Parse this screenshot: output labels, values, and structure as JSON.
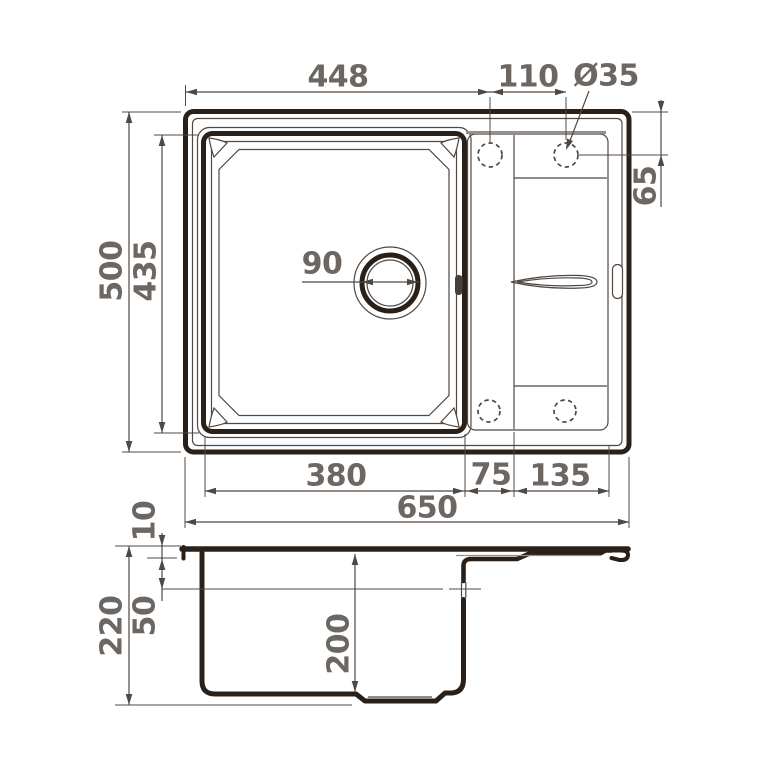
{
  "drawing_title": "sink-dimension-drawing",
  "colors": {
    "ink": "#2b2018",
    "line": "#4f4843",
    "text": "#6c6762",
    "ledge": "#95908a",
    "background": "#ffffff"
  },
  "top_view": {
    "dim_edge_to_hole": "448",
    "dim_hole_spacing": "110",
    "dim_hole_diameter": "Ø35",
    "dim_hole_offset": "65",
    "dim_overall_depth": "500",
    "dim_bowl_depth": "435",
    "dim_drain_diameter": "90",
    "dim_bowl_width": "380",
    "dim_web_width": "75",
    "dim_wing_width": "135",
    "dim_overall_width": "650"
  },
  "section_view": {
    "dim_rim_height": "10",
    "dim_overflow_offset": "50",
    "dim_overall_height": "220",
    "dim_bowl_height": "200"
  }
}
